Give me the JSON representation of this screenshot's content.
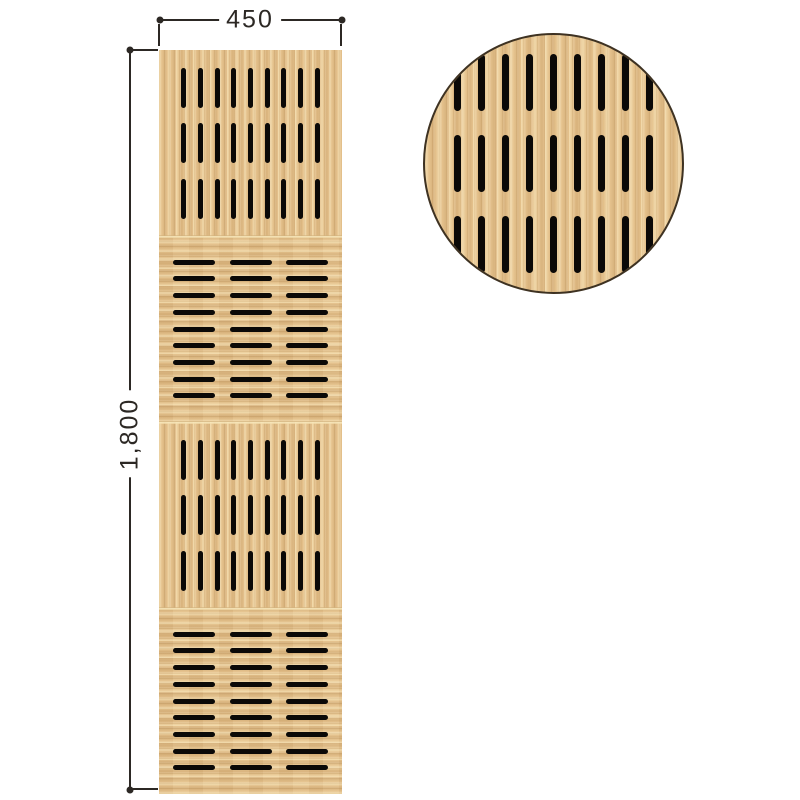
{
  "drawing": {
    "kind": "slotted wood acoustic panel elevation with magnified detail"
  },
  "dimensions": {
    "width_label": "450",
    "height_label": "1,800"
  },
  "panel": {
    "sections": [
      {
        "pattern": "vertical",
        "rows": 3,
        "cols": 9
      },
      {
        "pattern": "horizontal",
        "rows": 9,
        "cols": 3
      },
      {
        "pattern": "vertical",
        "rows": 3,
        "cols": 9
      },
      {
        "pattern": "horizontal",
        "rows": 9,
        "cols": 3
      }
    ]
  },
  "detail_view": {
    "shape": "circle",
    "pattern": "vertical",
    "rows": 3,
    "cols": 9
  },
  "colors": {
    "wood_base": "#e5c28d",
    "wood_grain_dark": "#c9a06a",
    "wood_grain_light": "#f5e0b2",
    "slot": "#0b0907",
    "line": "#2c2824",
    "text": "#2c2824",
    "circle_outline": "#3e3222",
    "background": "#ffffff"
  }
}
